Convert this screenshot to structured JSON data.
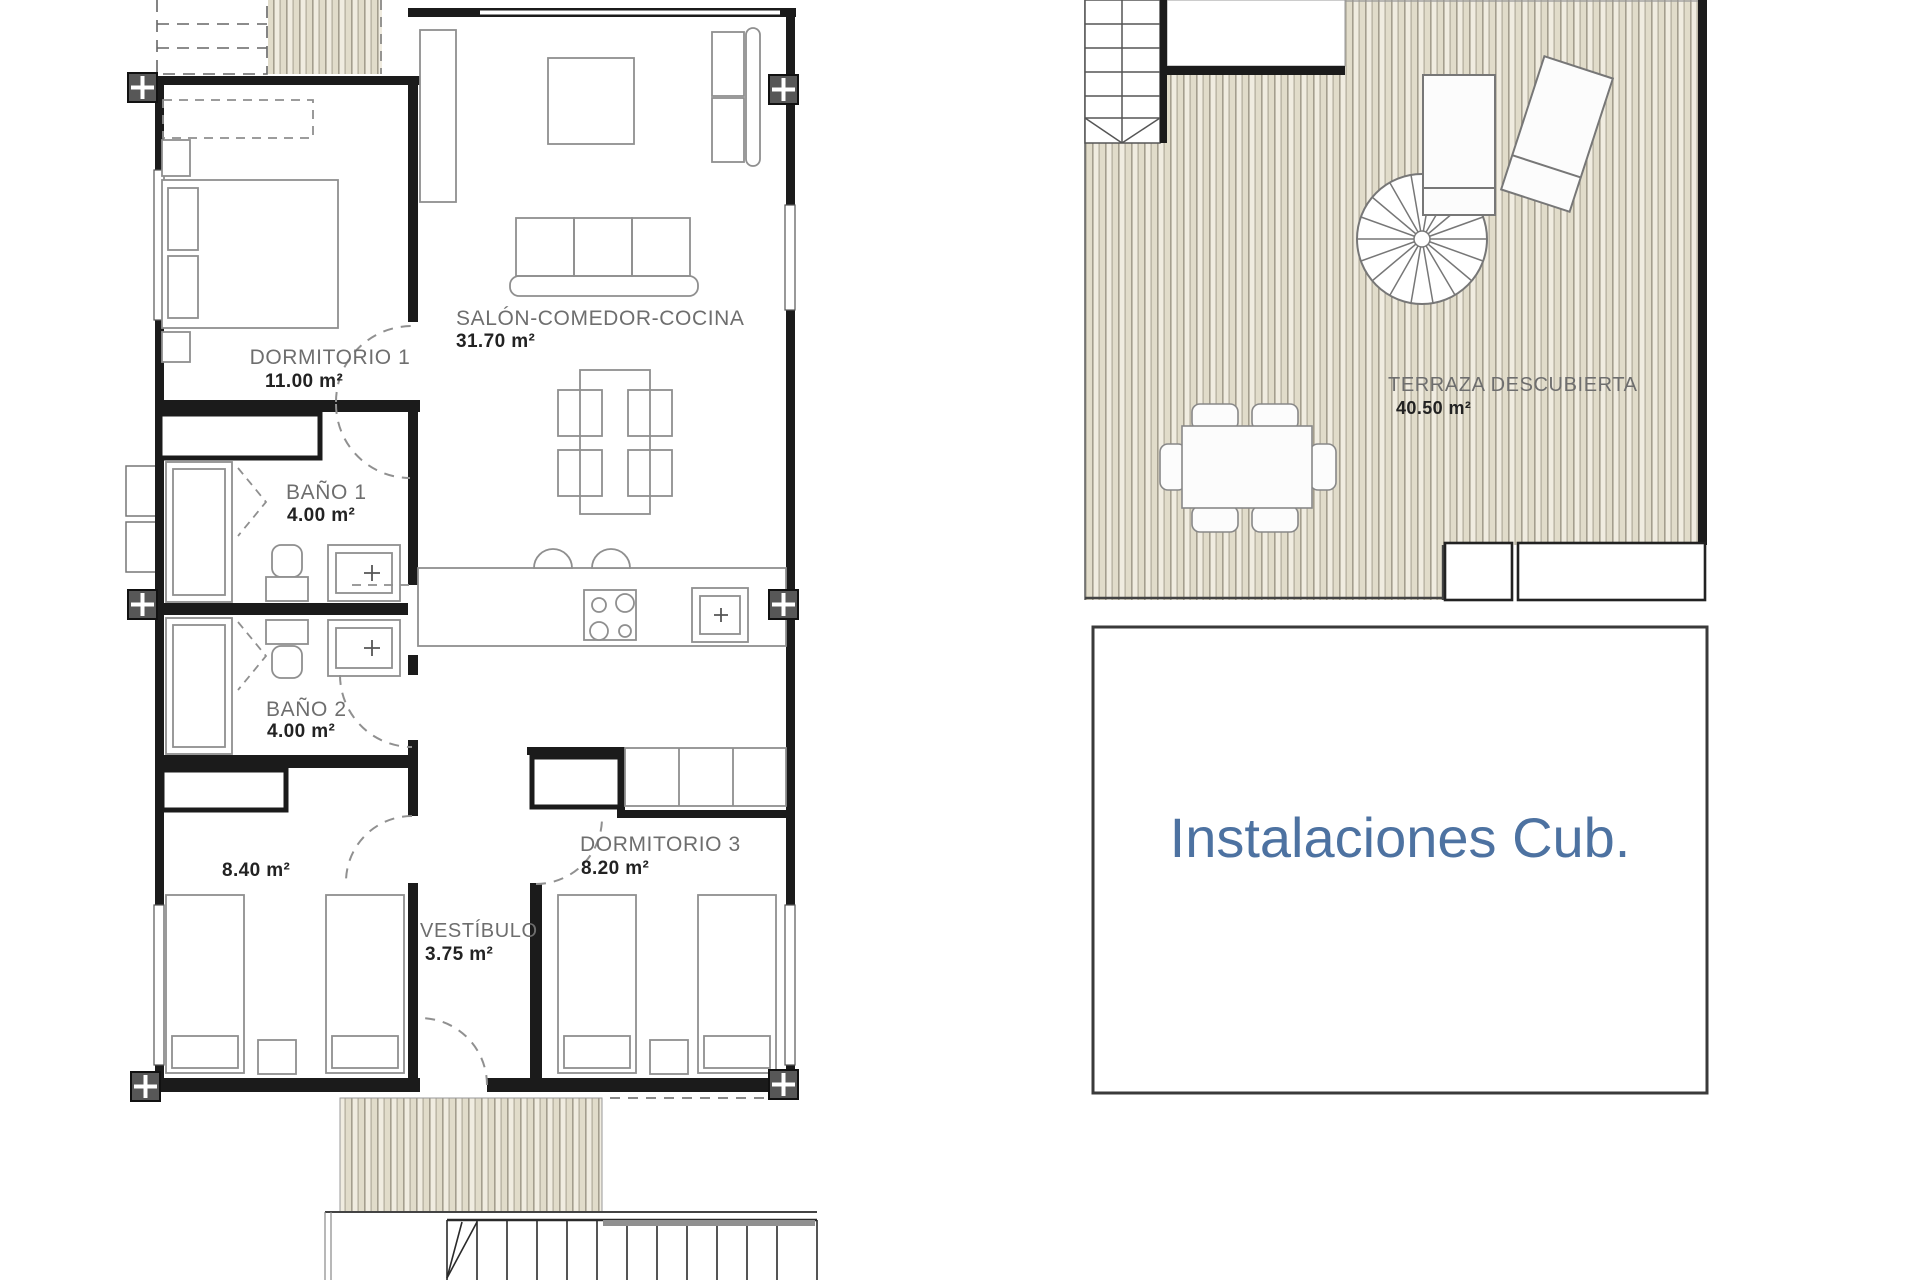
{
  "document": {
    "type": "floor-plan",
    "sheet_background": "#ffffff"
  },
  "colors": {
    "walls": "#1b1b1b",
    "furniture_line": "#8f8f8f",
    "deck_stripe_light": "#f0ece0",
    "deck_stripe_dark": "#e1dcca",
    "deck_stripe_line": "#a49e8e",
    "room_label": "#6e6e6e",
    "area_label": "#222222",
    "instalaciones_text": "#4d72a1",
    "column_marker": "#575757"
  },
  "rooms": {
    "dormitorio1": {
      "name": "DORMITORIO 1",
      "area": "11.00 m²"
    },
    "salon": {
      "name": "SALÓN-COMEDOR-COCINA",
      "area": "31.70 m²"
    },
    "bano1": {
      "name": "BAÑO 1",
      "area": "4.00 m²"
    },
    "bano2": {
      "name": "BAÑO 2",
      "area": "4.00 m²"
    },
    "dormitorio2": {
      "area": "8.40 m²"
    },
    "vestibulo": {
      "name": "VESTÍBULO",
      "area": "3.75 m²"
    },
    "dormitorio3": {
      "name": "DORMITORIO 3",
      "area": "8.20 m²"
    },
    "terraza": {
      "name": "TERRAZA DESCUBIERTA",
      "area": "40.50 m²"
    },
    "instalaciones": {
      "name": "Instalaciones Cub."
    }
  }
}
